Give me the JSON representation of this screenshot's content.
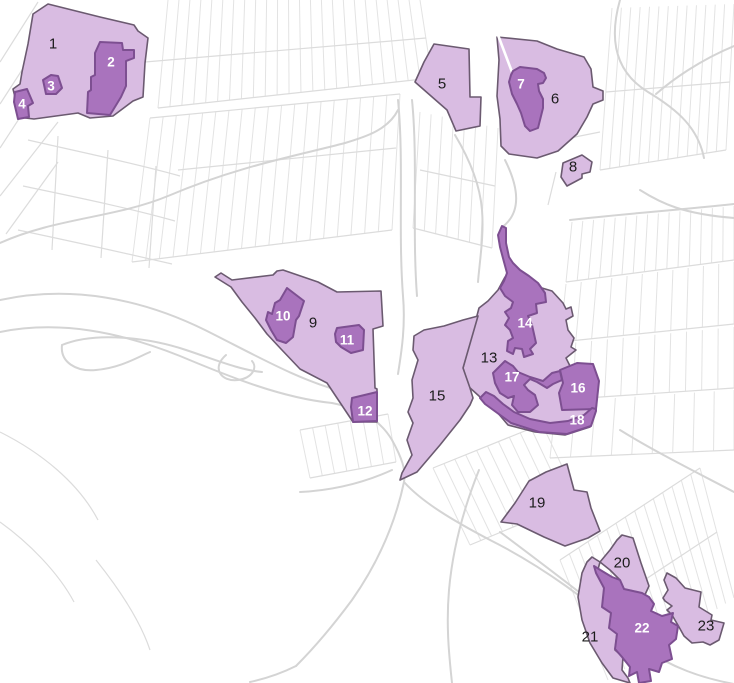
{
  "map": {
    "width": 734,
    "height": 683,
    "colors": {
      "background": "#ffffff",
      "road_line": "#d4d4d4",
      "parcel_line": "#e3e3e3",
      "parcel_line_2": "#dcdcdc",
      "zone_light_fill": "#d9bce2",
      "zone_dark_fill": "#a973bd",
      "zone_light_stroke": "#6b5a70",
      "zone_dark_stroke": "#7d4f91",
      "label_on_light": "#1c1c1c",
      "label_on_dark": "#ffffff"
    },
    "white_gap": "M498,35 L512,72",
    "zones": [
      {
        "id": "1",
        "label": "1",
        "shade": "light",
        "lx": 53,
        "ly": 44,
        "points": "33,14 48,4 100,17 134,25 138,31 148,38 145,63 143,97 133,101 113,116 90,118 78,113 34,119 25,118 23,103 15,97 13,89 20,84 22,72 28,44"
      },
      {
        "id": "2",
        "label": "2",
        "shade": "dark",
        "lx": 111,
        "ly": 62,
        "points": "100,42 122,43 123,50 134,50 134,58 126,61 126,86 121,97 110,115 87,113 88,92 91,90 91,77 95,75 95,53"
      },
      {
        "id": "3",
        "label": "3",
        "shade": "dark",
        "lx": 51,
        "ly": 86,
        "points": "43,80 51,75 58,76 62,88 56,94 46,94"
      },
      {
        "id": "4",
        "label": "4",
        "shade": "dark",
        "lx": 22,
        "ly": 104,
        "points": "15,92 27,89 33,103 28,106 29,117 18,119 14,102"
      },
      {
        "id": "5",
        "label": "5",
        "shade": "light",
        "lx": 442,
        "ly": 84,
        "points": "434,44 469,49 470,97 481,97 480,126 456,131 447,110 415,82 424,62"
      },
      {
        "id": "6",
        "label": "6",
        "shade": "light",
        "lx": 555,
        "ly": 99,
        "points": "497,37 537,41 557,49 584,57 591,69 593,87 603,91 603,100 593,104 587,117 577,134 558,151 537,158 509,154 501,146 500,119 497,96 499,60"
      },
      {
        "id": "7",
        "label": "7",
        "shade": "dark",
        "lx": 521,
        "ly": 84,
        "points": "513,71 520,67 537,69 544,73 546,78 543,83 538,84 539,91 543,99 543,108 540,120 538,128 530,131 525,126 521,113 517,104 512,94 509,82 511,75"
      },
      {
        "id": "8",
        "label": "8",
        "shade": "light",
        "lx": 573,
        "ly": 167,
        "points": "563,163 582,155 592,162 590,172 582,174 582,178 567,186 561,177"
      },
      {
        "id": "9",
        "label": "9",
        "shade": "light",
        "lx": 313,
        "ly": 323,
        "points": "215,277 221,273 232,280 273,275 277,271 283,270 318,282 337,292 381,291 383,326 373,329 375,388 377,389 377,422 353,422 327,383 300,369 281,349 267,334 255,318 242,302 231,287"
      },
      {
        "id": "10",
        "label": "10",
        "shade": "dark",
        "lx": 283,
        "ly": 316,
        "points": "287,288 304,301 299,316 296,320 293,337 286,343 277,340 271,330 266,320 268,312 272,314 275,303 280,300"
      },
      {
        "id": "11",
        "label": "11",
        "shade": "dark",
        "lx": 347,
        "ly": 340,
        "points": "337,328 359,325 364,330 363,350 351,353 341,347 336,342 335,334"
      },
      {
        "id": "12",
        "label": "12",
        "shade": "dark",
        "lx": 365,
        "ly": 411,
        "points": "352,398 377,392 377,421 353,422 351,407"
      },
      {
        "id": "13",
        "label": "13",
        "shade": "light",
        "lx": 489,
        "ly": 358,
        "points": "505,277 552,291 563,303 566,309 571,307 573,316 566,320 568,330 574,338 571,347 576,350 566,358 570,366 593,365 598,382 596,410 590,427 565,435 535,432 508,425 497,412 486,404 479,396 469,387 463,368 479,308 488,301 498,290"
      },
      {
        "id": "14",
        "label": "14",
        "shade": "dark",
        "lx": 525,
        "ly": 323,
        "points": "502,226 506,228 506,243 509,257 513,263 520,270 529,276 538,283 545,293 546,302 536,304 537,313 528,316 532,325 534,334 536,343 530,349 533,354 524,357 522,349 515,348 513,354 507,351 508,341 513,338 510,330 505,325 509,318 505,312 511,308 513,302 505,296 500,288 504,281 507,273 504,262 500,247 498,235"
      },
      {
        "id": "15",
        "label": "15",
        "shade": "light",
        "lx": 437,
        "ly": 396,
        "points": "414,336 424,330 444,326 463,320 478,316 463,368 470,388 473,398 470,405 460,420 440,445 417,472 400,480 402,473 412,455 407,440 413,423 408,412 413,398 412,380 418,360 413,350"
      },
      {
        "id": "16",
        "label": "16",
        "shade": "dark",
        "lx": 578,
        "ly": 388,
        "points": "560,370 577,363 593,364 599,381 596,409 562,410 559,393 563,383"
      },
      {
        "id": "17",
        "label": "17",
        "shade": "dark",
        "lx": 512,
        "ly": 377,
        "points": "499,367 505,361 513,366 518,372 530,377 543,381 552,373 560,371 562,380 553,384 547,388 537,382 530,379 524,385 528,390 535,395 538,405 530,412 518,412 512,405 514,396 508,398 500,393 495,383 493,373"
      },
      {
        "id": "18",
        "label": "18",
        "shade": "dark",
        "lx": 577,
        "ly": 420,
        "points": "480,398 486,392 494,396 503,404 514,412 530,419 550,423 568,421 584,415 592,408 596,409 596,411 591,426 567,434 539,432 511,423 496,412 485,404"
      },
      {
        "id": "19",
        "label": "19",
        "shade": "light",
        "lx": 537,
        "ly": 503,
        "points": "567,464 574,490 587,492 591,508 600,531 588,538 565,546 544,537 517,524 501,522 515,503 529,481 546,472"
      },
      {
        "id": "20",
        "label": "20",
        "shade": "light",
        "lx": 622,
        "ly": 563,
        "points": "622,535 633,538 641,563 649,586 643,599 633,591 624,589 620,580 610,570 600,562 610,550 617,540"
      },
      {
        "id": "21",
        "label": "21",
        "shade": "light",
        "lx": 590,
        "ly": 637,
        "points": "592,557 600,562 597,573 605,588 603,607 612,613 610,628 617,633 615,650 623,657 622,670 628,678 630,683 613,678 602,663 590,643 582,620 578,597 582,573 587,562"
      },
      {
        "id": "22",
        "label": "22",
        "shade": "dark",
        "lx": 642,
        "ly": 628,
        "points": "594,566 602,571 612,577 620,580 624,589 633,591 642,593 649,597 654,604 651,611 662,616 673,613 671,622 678,626 676,639 669,645 672,659 662,663 659,672 649,669 651,681 639,683 637,672 629,676 630,667 622,657 615,649 617,634 609,628 611,613 602,607 604,588 596,573"
      },
      {
        "id": "23",
        "label": "23",
        "shade": "light",
        "lx": 706,
        "ly": 626,
        "points": "667,573 676,578 685,588 701,592 699,607 712,615 711,620 724,623 719,640 710,645 703,642 692,643 684,636 679,627 672,615 667,610 672,606 665,601 663,598 668,590 664,580"
      }
    ]
  },
  "background": {
    "roads": [
      "M0,243 C55,218 115,218 168,196 C238,166 300,155 345,143",
      "M345,143 C365,137 388,130 398,110",
      "M398,100 C404,160 398,230 403,296 C406,330 400,360 398,374",
      "M412,100 C418,160 412,230 417,296",
      "M0,300 C70,285 140,298 205,330 C255,355 302,382 345,392",
      "M0,332 C60,320 120,332 180,356 C230,377 282,398 332,403",
      "M62,345 C96,331 150,338 186,350 C216,360 240,370 262,372",
      "M62,345 C60,362 76,372 96,370 C120,368 136,358 150,352",
      "M226,355 C211,368 221,382 238,380 C252,378 258,368 252,361",
      "M332,403 C362,409 380,420 392,440 C402,458 406,470 404,482",
      "M404,482 C422,502 452,520 490,540 C540,565 592,602 640,646",
      "M392,470 C370,480 340,490 300,492",
      "M404,482 C396,520 380,560 352,600 C332,627 312,650 296,666",
      "M479,470 C465,505 453,545 449,590 C446,625 449,655 452,683",
      "M620,0 C610,35 612,70 648,92 C678,110 698,128 704,158",
      "M734,46 C700,60 672,80 656,94",
      "M640,190 C662,204 684,214 734,218",
      "M570,220 C620,214 680,210 734,204",
      "M505,160 C520,190 521,214 501,228",
      "M455,135 C470,160 480,185 482,210 C484,235 480,258 478,282",
      "M640,646 C672,668 702,678 734,684",
      "M620,430 C652,450 692,470 734,492",
      "M500,532 C540,562 580,592 622,626",
      "M296,666 C280,674 264,679 250,682"
    ],
    "hatches": [
      {
        "a": [
          168,
          0
        ],
        "b": [
          420,
          0
        ],
        "c": [
          158,
          108
        ],
        "d": [
          432,
          78
        ],
        "n": 24
      },
      {
        "a": [
          150,
          118
        ],
        "b": [
          400,
          94
        ],
        "c": [
          132,
          262
        ],
        "d": [
          392,
          230
        ],
        "n": 20
      },
      {
        "a": [
          612,
          8
        ],
        "b": [
          734,
          4
        ],
        "c": [
          600,
          170
        ],
        "d": [
          726,
          150
        ],
        "n": 14
      },
      {
        "a": [
          572,
          222
        ],
        "b": [
          734,
          206
        ],
        "c": [
          566,
          282
        ],
        "d": [
          734,
          260
        ],
        "n": 16
      },
      {
        "a": [
          566,
          284
        ],
        "b": [
          734,
          262
        ],
        "c": [
          560,
          342
        ],
        "d": [
          734,
          324
        ],
        "n": 12
      },
      {
        "a": [
          560,
          344
        ],
        "b": [
          734,
          327
        ],
        "c": [
          556,
          400
        ],
        "d": [
          734,
          388
        ],
        "n": 12
      },
      {
        "a": [
          556,
          402
        ],
        "b": [
          734,
          390
        ],
        "c": [
          550,
          458
        ],
        "d": [
          734,
          450
        ],
        "n": 10
      },
      {
        "a": [
          420,
          112
        ],
        "b": [
          498,
          128
        ],
        "c": [
          413,
          228
        ],
        "d": [
          492,
          248
        ],
        "n": 8
      },
      {
        "a": [
          433,
          468
        ],
        "b": [
          542,
          424
        ],
        "c": [
          470,
          545
        ],
        "d": [
          578,
          500
        ],
        "n": 11
      },
      {
        "a": [
          560,
          560
        ],
        "b": [
          700,
          468
        ],
        "c": [
          608,
          680
        ],
        "d": [
          734,
          598
        ],
        "n": 16
      },
      {
        "a": [
          300,
          430
        ],
        "b": [
          388,
          414
        ],
        "c": [
          310,
          478
        ],
        "d": [
          396,
          462
        ],
        "n": 8
      }
    ],
    "extras": [
      "M158,108 L432,78",
      "M150,118 L400,94",
      "M132,262 L392,230",
      "M145,62 L426,38",
      "M178,170 L396,148",
      "M600,170 L726,150",
      "M606,92 L730,82",
      "M566,282 L734,260",
      "M560,342 L734,324",
      "M556,400 L734,388",
      "M550,458 L734,450",
      "M413,228 L492,248",
      "M420,170 L495,186",
      "M433,468 L542,424",
      "M470,545 L578,500",
      "M560,560 L700,468",
      "M584,620 L717,532",
      "M300,430 L388,414",
      "M310,478 L396,462",
      "M0,62 L38,2",
      "M0,104 L62,8",
      "M0,148 L86,16",
      "M0,196 L58,122",
      "M6,234 L58,162",
      "M28,140 C80,152 130,162 180,176",
      "M23,186 C75,197 125,207 175,221",
      "M18,230 C70,241 120,252 172,264",
      "M58,136 L52,250",
      "M108,150 L101,258",
      "M156,166 L149,268",
      "M560,140 L600,132",
      "M556,172 L548,205",
      "M0,432 C40,452 78,482 98,520",
      "M0,522 C28,542 58,572 74,602",
      "M96,560 C120,590 140,620 150,650"
    ]
  }
}
